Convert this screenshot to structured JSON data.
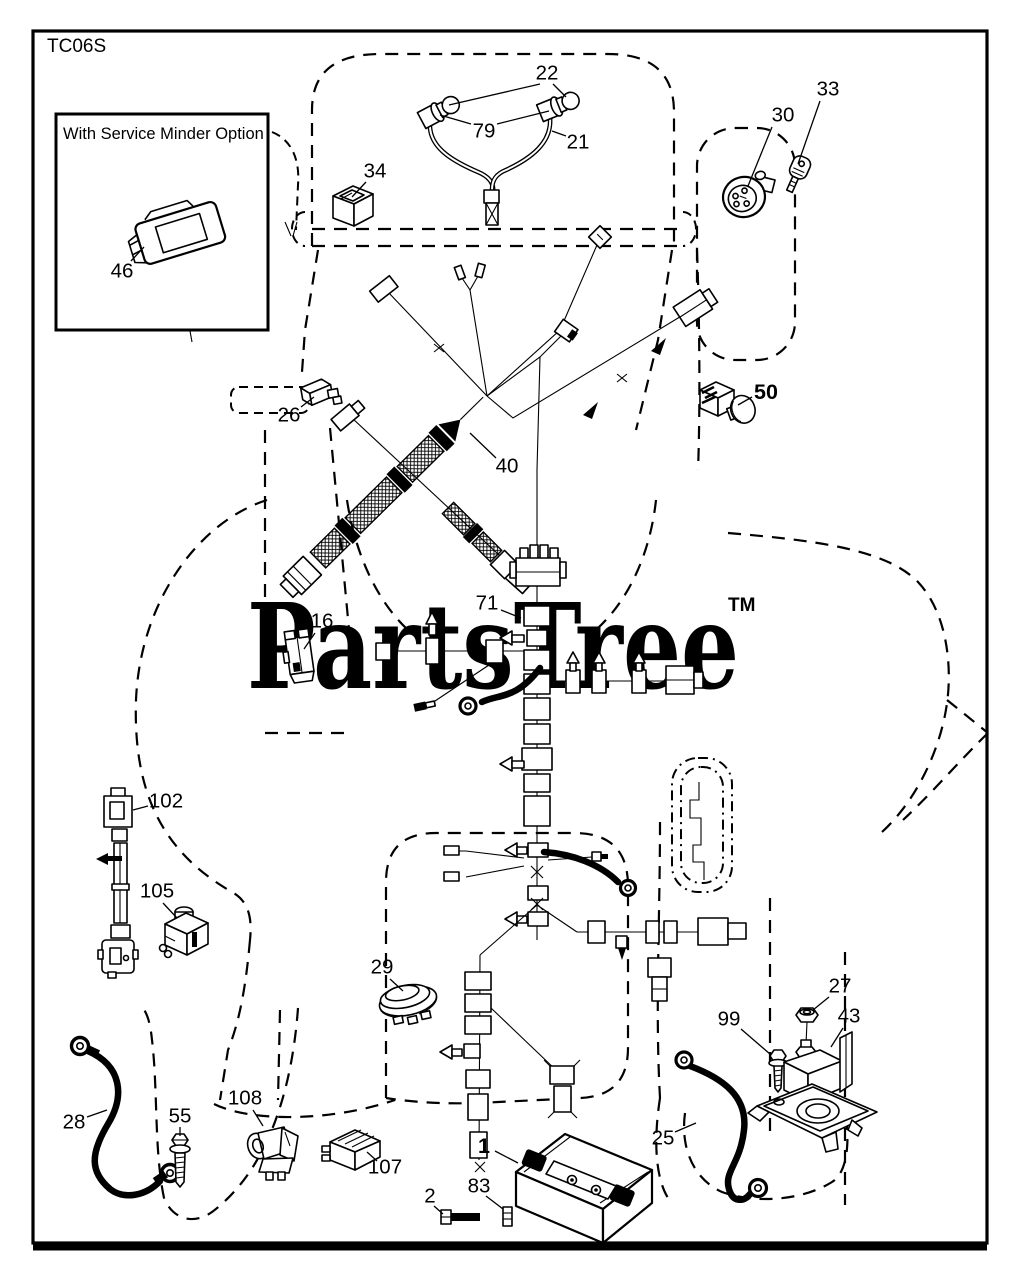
{
  "page": {
    "width": 1016,
    "height": 1280,
    "background": "#ffffff",
    "line_color": "#000000"
  },
  "diagram": {
    "code": "TC06S"
  },
  "inset": {
    "title": "With Service Minder Option"
  },
  "watermark": {
    "text": "PartsTree",
    "tm": "TM",
    "color": "#c8c8c8"
  },
  "callouts": [
    {
      "id": "22",
      "x": 547,
      "y": 73,
      "bold": false,
      "leaders": [
        [
          540,
          84,
          449,
          105
        ],
        [
          553,
          84,
          566,
          97
        ]
      ]
    },
    {
      "id": "79",
      "x": 484,
      "y": 131,
      "bold": false,
      "leaders": [
        [
          471,
          124,
          440,
          115
        ],
        [
          497,
          124,
          549,
          111
        ]
      ]
    },
    {
      "id": "21",
      "x": 578,
      "y": 142,
      "bold": false,
      "leaders": [
        [
          566,
          136,
          552,
          131
        ]
      ]
    },
    {
      "id": "34",
      "x": 375,
      "y": 171,
      "bold": false,
      "leaders": [
        [
          366,
          182,
          352,
          197
        ]
      ]
    },
    {
      "id": "30",
      "x": 783,
      "y": 115,
      "bold": false,
      "leaders": [
        [
          772,
          127,
          748,
          186
        ]
      ]
    },
    {
      "id": "33",
      "x": 828,
      "y": 89,
      "bold": false,
      "leaders": [
        [
          820,
          101,
          798,
          164
        ]
      ]
    },
    {
      "id": "46",
      "x": 122,
      "y": 271,
      "bold": false,
      "leaders": [
        [
          131,
          261,
          144,
          247
        ]
      ]
    },
    {
      "id": "26",
      "x": 289,
      "y": 415,
      "bold": false,
      "leaders": [
        [
          301,
          407,
          314,
          397
        ]
      ]
    },
    {
      "id": "40",
      "x": 507,
      "y": 466,
      "bold": false,
      "leaders": [
        [
          496,
          458,
          470,
          433
        ]
      ]
    },
    {
      "id": "50",
      "x": 766,
      "y": 392,
      "bold": true,
      "leaders": [
        [
          752,
          397,
          738,
          405
        ]
      ]
    },
    {
      "id": "16",
      "x": 322,
      "y": 621,
      "bold": false,
      "leaders": [
        [
          315,
          633,
          304,
          649
        ]
      ]
    },
    {
      "id": "71",
      "x": 487,
      "y": 603,
      "bold": false,
      "leaders": [
        [
          501,
          610,
          521,
          618
        ]
      ]
    },
    {
      "id": "102",
      "x": 166,
      "y": 801,
      "bold": false,
      "leaders": [
        [
          148,
          806,
          133,
          810
        ]
      ]
    },
    {
      "id": "105",
      "x": 157,
      "y": 891,
      "bold": false,
      "leaders": [
        [
          163,
          903,
          177,
          918
        ]
      ]
    },
    {
      "id": "29",
      "x": 382,
      "y": 967,
      "bold": false,
      "leaders": [
        [
          390,
          979,
          403,
          991
        ]
      ]
    },
    {
      "id": "27",
      "x": 840,
      "y": 986,
      "bold": false,
      "leaders": [
        [
          829,
          997,
          813,
          1010
        ]
      ]
    },
    {
      "id": "99",
      "x": 729,
      "y": 1019,
      "bold": false,
      "leaders": [
        [
          741,
          1029,
          770,
          1054
        ]
      ]
    },
    {
      "id": "43",
      "x": 849,
      "y": 1016,
      "bold": false,
      "leaders": [
        [
          843,
          1028,
          831,
          1047
        ]
      ]
    },
    {
      "id": "28",
      "x": 74,
      "y": 1122,
      "bold": false,
      "leaders": [
        [
          87,
          1117,
          107,
          1110
        ]
      ]
    },
    {
      "id": "55",
      "x": 180,
      "y": 1116,
      "bold": false,
      "leaders": [
        [
          180,
          1127,
          180,
          1136
        ]
      ]
    },
    {
      "id": "108",
      "x": 245,
      "y": 1098,
      "bold": false,
      "leaders": [
        [
          253,
          1110,
          263,
          1126
        ]
      ]
    },
    {
      "id": "107",
      "x": 385,
      "y": 1167,
      "bold": false,
      "leaders": [
        [
          377,
          1161,
          367,
          1152
        ]
      ]
    },
    {
      "id": "1",
      "x": 484,
      "y": 1146,
      "bold": true,
      "leaders": [
        [
          495,
          1151,
          518,
          1163
        ]
      ]
    },
    {
      "id": "2",
      "x": 430,
      "y": 1196,
      "bold": false,
      "leaders": [
        [
          434,
          1206,
          443,
          1214
        ]
      ]
    },
    {
      "id": "83",
      "x": 479,
      "y": 1186,
      "bold": false,
      "leaders": [
        [
          486,
          1196,
          503,
          1209
        ]
      ]
    },
    {
      "id": "25",
      "x": 663,
      "y": 1138,
      "bold": false,
      "leaders": [
        [
          675,
          1132,
          696,
          1123
        ]
      ]
    }
  ]
}
